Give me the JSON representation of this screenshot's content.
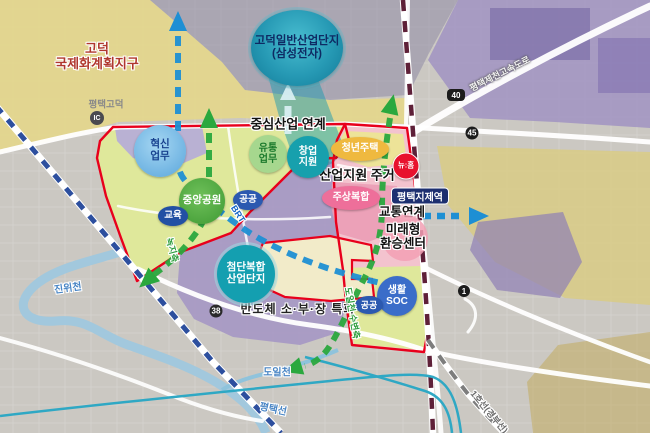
{
  "regions": {
    "godeok_international": "고덕\n국제화계획지구",
    "godeok_industrial_complex": "고덕일반산업단지\n(삼성전자)"
  },
  "strategy_labels": {
    "central_industry_link": "중심산업 연계",
    "industrial_support_housing": "산업지원 주거",
    "transport_link": "교통연계",
    "future_transfer_center": "미래형\n환승센터",
    "semiconductor_special": "반도체 소·부·장 특화"
  },
  "bubbles": {
    "innovation_business": "혁신\n업무",
    "distribution_business": "유통\n업무",
    "startup_support": "창업\n지원",
    "youth_housing": "청년주택",
    "central_park": "중앙공원",
    "public_1": "공공",
    "education": "교육",
    "mixed_use_housing": "주상복합",
    "hightech_complex": "첨단복합\n산업단지",
    "living_soc": "생활\nSOC",
    "public_2": "공공",
    "new_home": "뉴:홈"
  },
  "station": {
    "jije_station": "평택지제역"
  },
  "roads": {
    "interchange_name": "평택고덕",
    "interchange_badge": "IC",
    "route_40": "40",
    "route_45": "45",
    "route_38": "38",
    "route_1": "1",
    "expressway_name": "평택제천고속도로",
    "rail_line_1": "1호선(경부선)",
    "brt": "BRT"
  },
  "waterways": {
    "jinwi_stream": "진위천",
    "doil_stream": "도일천",
    "pyeongtaek_rail_line": "평택선"
  },
  "green_axes": {
    "green_axis": "녹지축",
    "doil_waterfront_axis": "도일천 수변축"
  },
  "colors": {
    "boundary_red": "#e8001c",
    "district_yellow_green": "#dfe89b",
    "housing_pink": "#f3c3ce",
    "industry_purple": "#a597c4",
    "anchor_teal": "#2699b4",
    "transit_green": "#2aa83e",
    "link_blue": "#1e8fd4",
    "newhome_red": "#e8112d",
    "station_navy": "#1d2f70",
    "zone_yellow": "#e4d68c"
  }
}
